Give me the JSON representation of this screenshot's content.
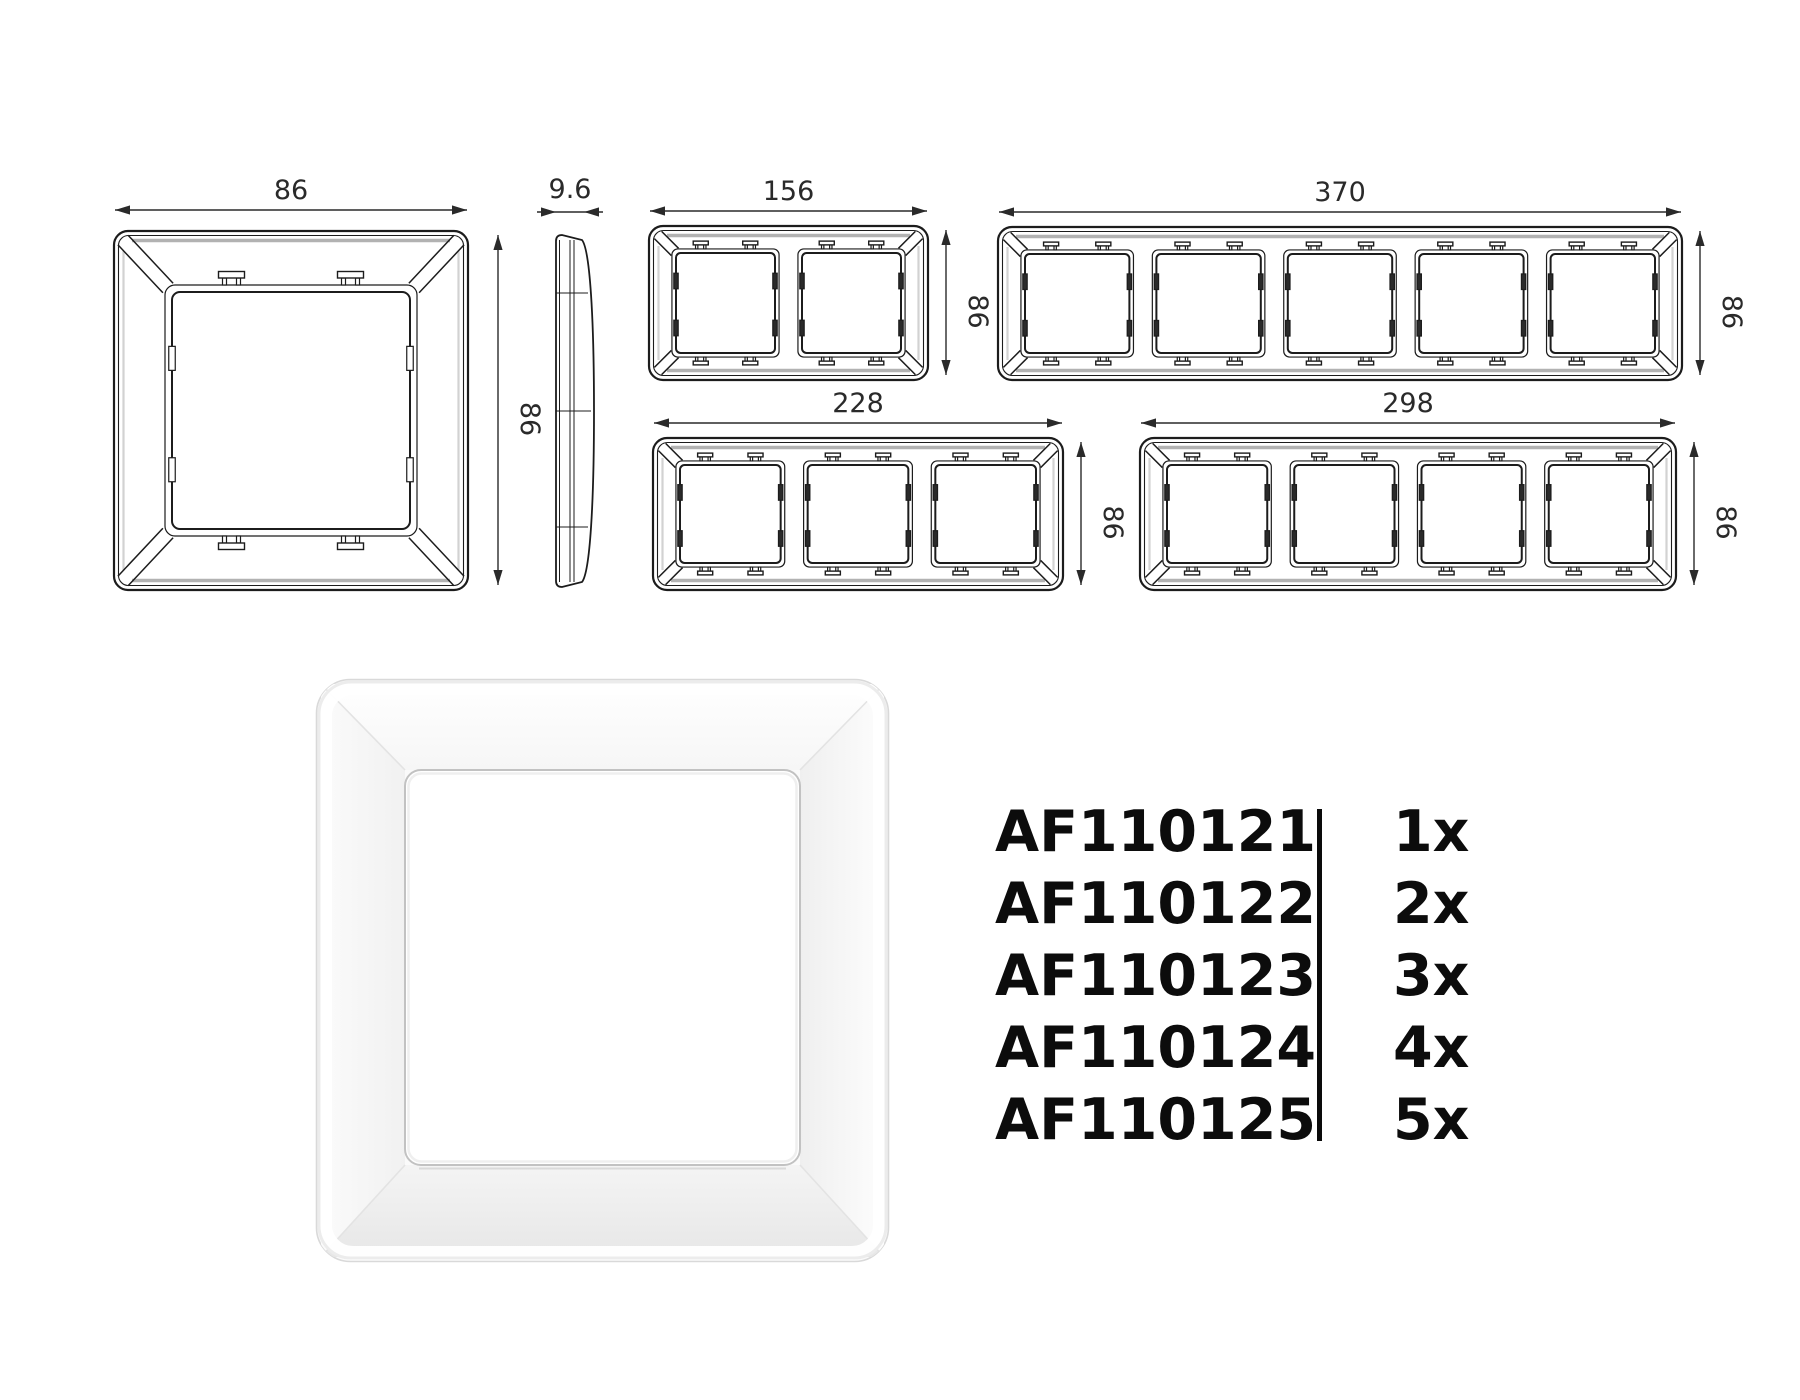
{
  "drawings": {
    "line_color": "#1c1c1c",
    "accent_gray": "#b2b2b2",
    "dim_color": "#2a2a2a",
    "dim_font_px": 27,
    "items": [
      {
        "id": "front-1gang",
        "type": "front",
        "gangs": 1,
        "x": 114,
        "y": 231,
        "w": 354,
        "h": 359,
        "width_label": "86",
        "height_label": "86"
      },
      {
        "id": "side-profile",
        "type": "side",
        "gangs": 0,
        "x": 553,
        "y": 232,
        "w": 42,
        "h": 358,
        "width_label": "9.6",
        "height_label": ""
      },
      {
        "id": "front-2gang",
        "type": "front",
        "gangs": 2,
        "x": 649,
        "y": 226,
        "w": 279,
        "h": 154,
        "width_label": "156",
        "height_label": "86"
      },
      {
        "id": "front-5gang",
        "type": "front",
        "gangs": 5,
        "x": 998,
        "y": 227,
        "w": 684,
        "h": 153,
        "width_label": "370",
        "height_label": "86"
      },
      {
        "id": "front-3gang",
        "type": "front",
        "gangs": 3,
        "x": 653,
        "y": 438,
        "w": 410,
        "h": 152,
        "width_label": "228",
        "height_label": "86"
      },
      {
        "id": "front-4gang",
        "type": "front",
        "gangs": 4,
        "x": 1140,
        "y": 438,
        "w": 536,
        "h": 152,
        "width_label": "298",
        "height_label": "86"
      }
    ]
  },
  "product_render": {
    "x": 315,
    "y": 678,
    "w": 575,
    "h": 585,
    "body_color": "#fafafa",
    "edge_color": "#d9d9d9",
    "opening_edge": "#c2c2c2",
    "shade_top": "#f6f6f6",
    "shade_left": "#f1f1f1",
    "shade_right": "#efefef",
    "shade_bottom": "#e7e7e7"
  },
  "parts_table": {
    "divider_color": "#0a0a0a",
    "rows": [
      {
        "code": "AF110121",
        "qty": "1x"
      },
      {
        "code": "AF110122",
        "qty": "2x"
      },
      {
        "code": "AF110123",
        "qty": "3x"
      },
      {
        "code": "AF110124",
        "qty": "4x"
      },
      {
        "code": "AF110125",
        "qty": "5x"
      }
    ]
  }
}
